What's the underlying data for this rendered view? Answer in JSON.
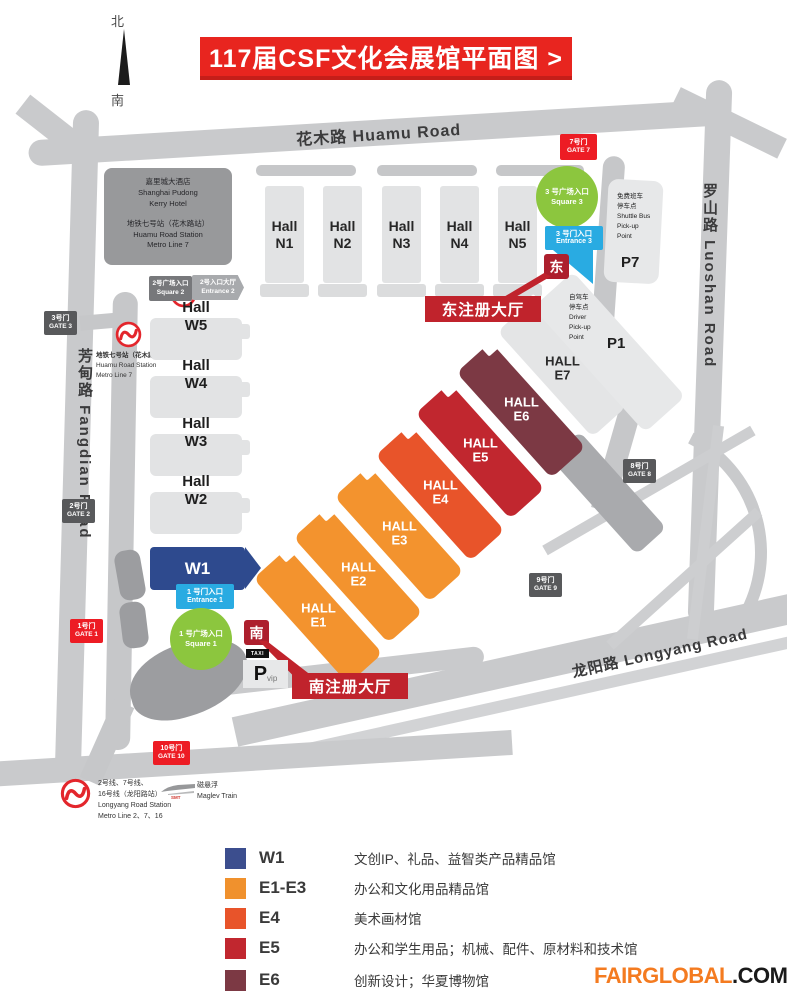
{
  "title": "117届CSF文化会展馆平面图 >",
  "compass": {
    "north": "北",
    "south": "南"
  },
  "roads": {
    "huamu": "花木路 Huamu Road",
    "luoshan": "罗山路 Luoshan Road",
    "fangdian": "芳甸路 Fangdian Road",
    "longyang": "龙阳路 Longyang Road"
  },
  "hotel": {
    "l1": "嘉里城大酒店",
    "l2": "Shanghai Pudong",
    "l3": "Kerry Hotel",
    "l4": "地铁七号站（花木路站）",
    "l5": "Huamu Road Station",
    "l6": "Metro Line 7"
  },
  "metro_left": {
    "l1": "地铁七号站（花木路站）",
    "l2": "Huamu Road Station",
    "l3": "Metro Line 7"
  },
  "metro_bottom": {
    "l1": "2号线、7号线、",
    "l2": "16号线（龙阳路站）",
    "l3": "Longyang Road Station",
    "l4": "Metro Line 2、7、16"
  },
  "maglev": {
    "cn": "磁悬浮",
    "en": "Maglev Train",
    "smt": "SMT"
  },
  "halls_n": [
    {
      "l1": "Hall",
      "l2": "N1"
    },
    {
      "l1": "Hall",
      "l2": "N2"
    },
    {
      "l1": "Hall",
      "l2": "N3"
    },
    {
      "l1": "Hall",
      "l2": "N4"
    },
    {
      "l1": "Hall",
      "l2": "N5"
    }
  ],
  "halls_w": [
    {
      "l1": "Hall",
      "l2": "W5"
    },
    {
      "l1": "Hall",
      "l2": "W4"
    },
    {
      "l1": "Hall",
      "l2": "W3"
    },
    {
      "l1": "Hall",
      "l2": "W2"
    }
  ],
  "hall_w1": {
    "label": "W1",
    "color": "#2E4A8E"
  },
  "halls_e": [
    {
      "l1": "HALL",
      "l2": "E1",
      "color": "#F3932E"
    },
    {
      "l1": "HALL",
      "l2": "E2",
      "color": "#F3932E"
    },
    {
      "l1": "HALL",
      "l2": "E3",
      "color": "#F3932E"
    },
    {
      "l1": "HALL",
      "l2": "E4",
      "color": "#E8542A"
    },
    {
      "l1": "HALL",
      "l2": "E5",
      "color": "#C1272F"
    },
    {
      "l1": "HALL",
      "l2": "E6",
      "color": "#7C3944"
    },
    {
      "l1": "HALL",
      "l2": "E7",
      "color": "#E4E5E6"
    }
  ],
  "gates": {
    "g1": {
      "cn": "1号门",
      "en": "GATE 1"
    },
    "g2": {
      "cn": "2号门",
      "en": "GATE 2"
    },
    "g3": {
      "cn": "3号门",
      "en": "GATE 3"
    },
    "g7": {
      "cn": "7号门",
      "en": "GATE 7"
    },
    "g8": {
      "cn": "8号门",
      "en": "GATE 8"
    },
    "g9": {
      "cn": "9号门",
      "en": "GATE 9"
    },
    "g10": {
      "cn": "10号门",
      "en": "GATE 10"
    }
  },
  "squares": {
    "s1": {
      "cn": "1 号广场入口",
      "en": "Square 1"
    },
    "s2": {
      "cn": "2号广场入口",
      "en": "Square 2"
    },
    "s3": {
      "cn": "3 号广场入口",
      "en": "Square 3"
    }
  },
  "entrances": {
    "e1": {
      "cn": "1 号门入口",
      "en": "Entrance 1"
    },
    "e2": {
      "cn": "2号入口大厅",
      "en": "Entrance 2"
    },
    "e3": {
      "cn": "3 号门入口",
      "en": "Entrance 3"
    }
  },
  "registration": {
    "east_badge": "东",
    "east_label": "东注册大厅",
    "south_badge": "南",
    "south_label": "南注册大厅"
  },
  "parking": {
    "p7_lines": [
      "免费班车",
      "停车点",
      "Shuttle Bus",
      "Pick-up",
      "Point"
    ],
    "p7": "P7",
    "p1_lines": [
      "自驾车",
      "停车点",
      "Driver",
      "Pick-up",
      "Point"
    ],
    "p1": "P1",
    "taxi": "TAXI",
    "vip_p": "P",
    "vip_sub": "vip"
  },
  "legend": [
    {
      "code": "W1",
      "desc": "文创IP、礼品、益智类产品精品馆",
      "color": "#3C4E8E"
    },
    {
      "code": "E1-E3",
      "desc": "办公和文化用品精品馆",
      "color": "#F0912D"
    },
    {
      "code": "E4",
      "desc": "美术画材馆",
      "color": "#E8542A"
    },
    {
      "code": "E5",
      "desc": "办公和学生用品；机械、配件、原材料和技术馆",
      "color": "#C1272F"
    },
    {
      "code": "E6",
      "desc": "创新设计；华夏博物馆",
      "color": "#7C3944"
    }
  ],
  "footer": {
    "orange": "FAIRGLOBAL",
    "black": ".COM.CN"
  },
  "colors": {
    "accent_red": "#E8251F",
    "badge_red": "#ED1C24",
    "dark_badge": "#58595B",
    "reg_red": "#C0232C",
    "badge_dark_red": "#AD1F2D",
    "cyan": "#29ABE2",
    "green": "#8CC63E"
  }
}
